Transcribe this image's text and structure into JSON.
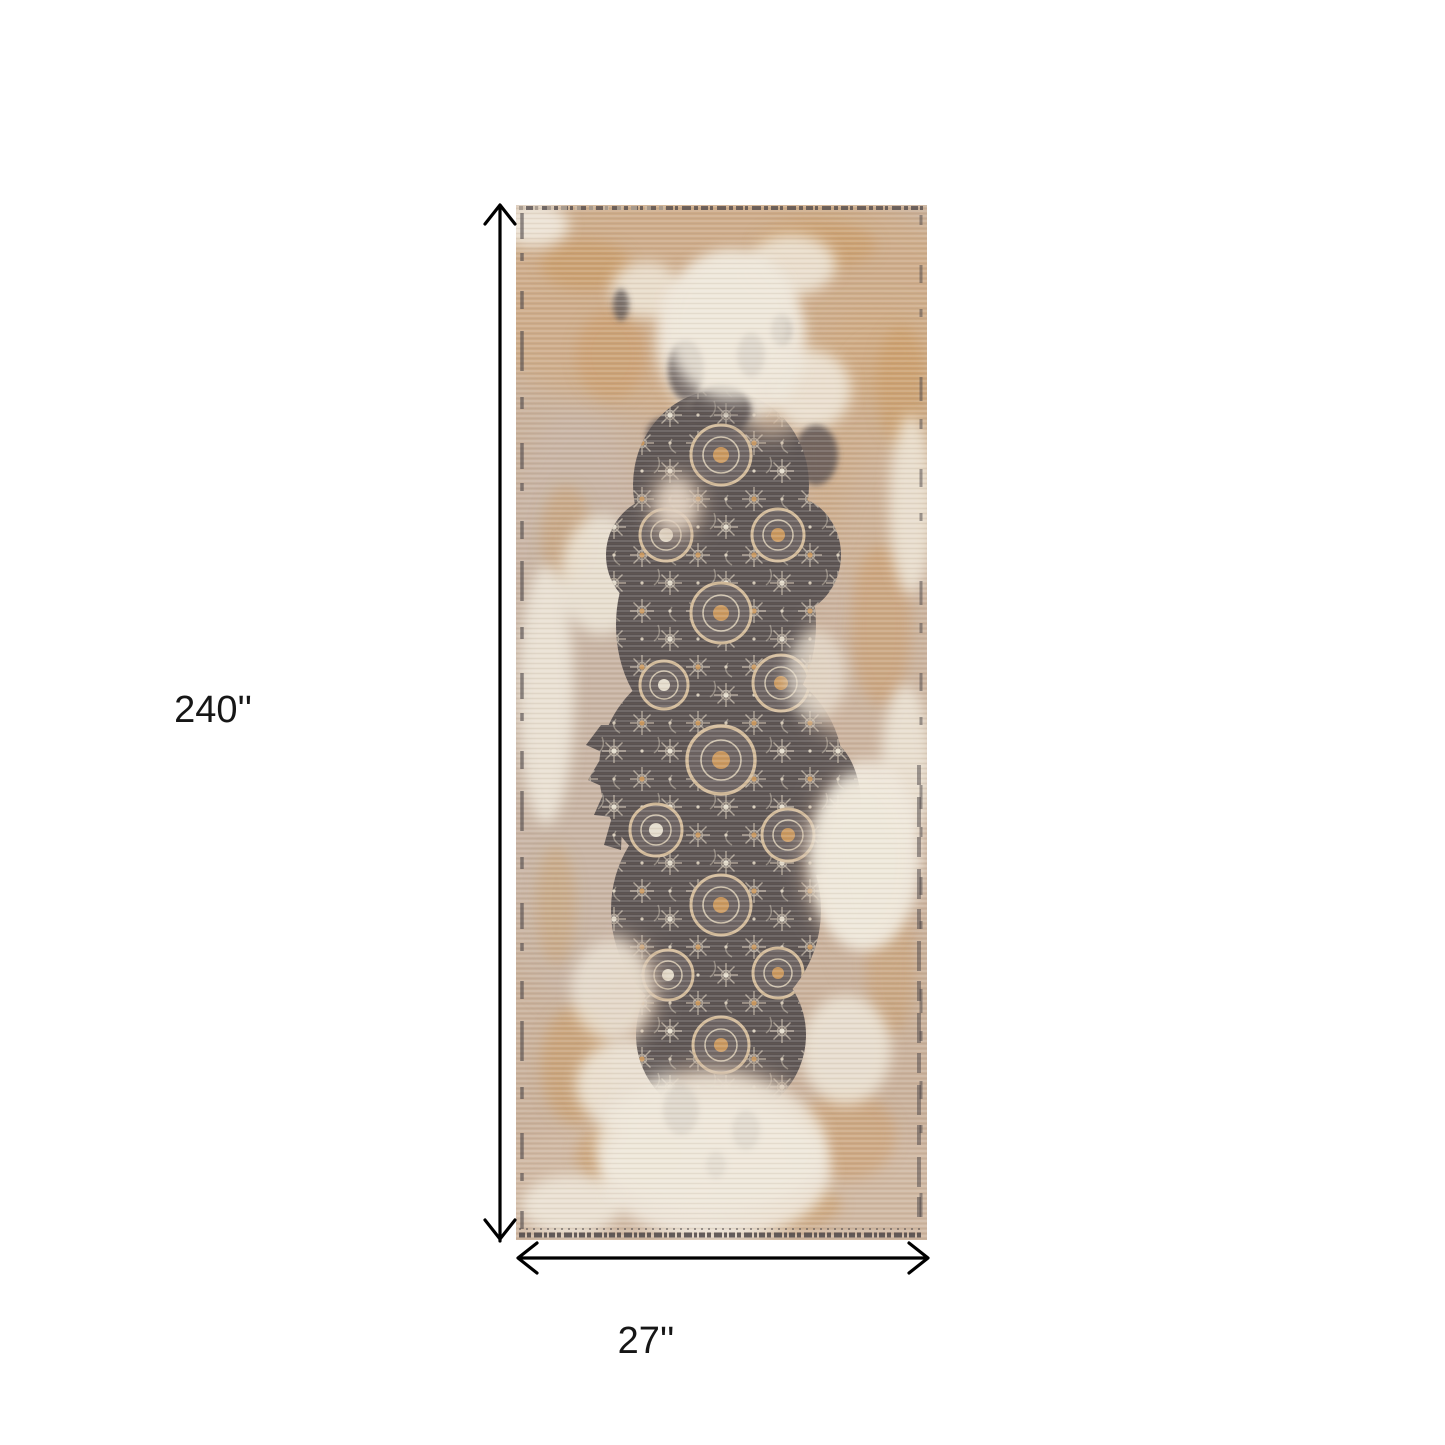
{
  "page": {
    "background_color": "#ffffff"
  },
  "dimension_annotations": {
    "height_label": "240''",
    "width_label": "27''",
    "arrow_color": "#000000",
    "label_color": "#161616"
  },
  "product_image": {
    "subject": "distressed vintage oriental runner rug",
    "palette": {
      "field_tan": "#c9b09a",
      "field_orange": "#cfa87c",
      "cream": "#efe8db",
      "rust": "#c9975d",
      "charcoal": "#5a5251",
      "tracery": "#bdb2a3",
      "medallion_ring": "#d3bb9a",
      "medallion_center": "#c9975d",
      "edge_dark": "#4c4648"
    }
  }
}
